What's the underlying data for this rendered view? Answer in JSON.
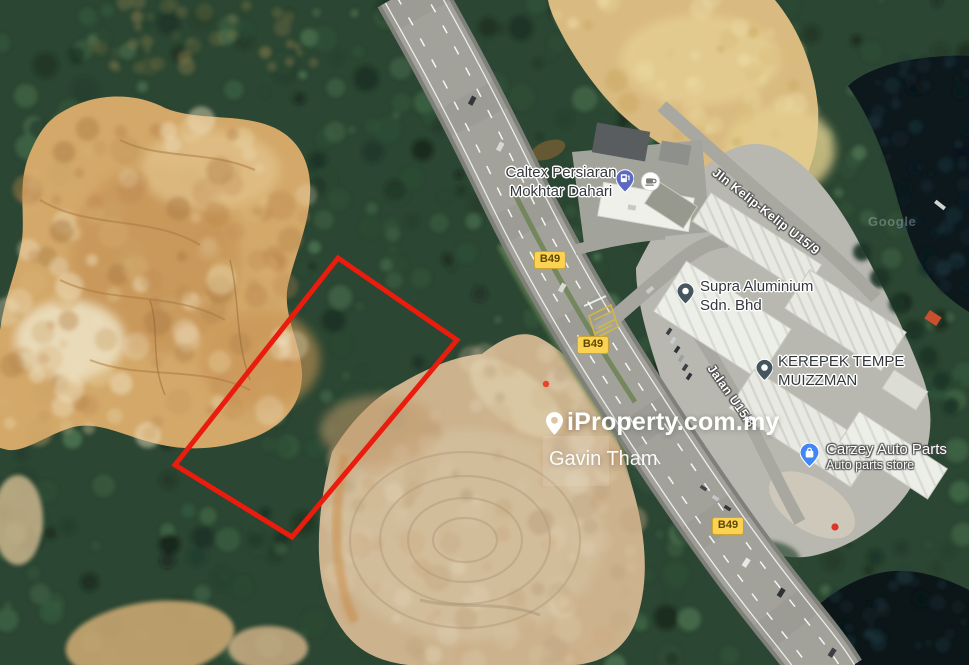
{
  "map_type": "satellite",
  "parcel": {
    "outline_color": "#ea1c0d"
  },
  "pois": {
    "caltex": {
      "line1": "Caltex Persiaran",
      "line2": "Mokhtar Dahari",
      "icon": "fuel-pin-icon"
    },
    "cafe": {
      "icon": "cafe-icon"
    },
    "supra": {
      "line1": "Supra Aluminium",
      "line2": "Sdn. Bhd",
      "icon": "place-pin-icon"
    },
    "kerepek": {
      "line1": "KEREPEK TEMPE",
      "line2": "MUIZZMAN",
      "icon": "place-pin-icon"
    },
    "carzey": {
      "name": "Carzey Auto Parts",
      "category": "Auto parts store",
      "icon": "shopping-pin-icon"
    }
  },
  "roads": {
    "route_badges": [
      {
        "label": "B49"
      },
      {
        "label": "B49"
      },
      {
        "label": "B49"
      }
    ],
    "street_labels": [
      {
        "name": "Jln Kelip-Kelip U15/9"
      },
      {
        "name": "Jalan U15/8"
      }
    ]
  },
  "watermark": {
    "brand": "iProperty.com.my",
    "agent": "Gavin Tham",
    "icon": "location-pin-icon"
  },
  "attribution": {
    "text": "Google"
  },
  "colors": {
    "route_badge_bg": "#fcd253",
    "route_badge_text": "#5d4702",
    "poi_text": "#33373c",
    "street_text": "#ffffff",
    "fuel_pin": "#5c6ac2",
    "place_pin": "#47565e",
    "shop_pin": "#4285f4",
    "parcel_red": "#ea1c0d"
  }
}
